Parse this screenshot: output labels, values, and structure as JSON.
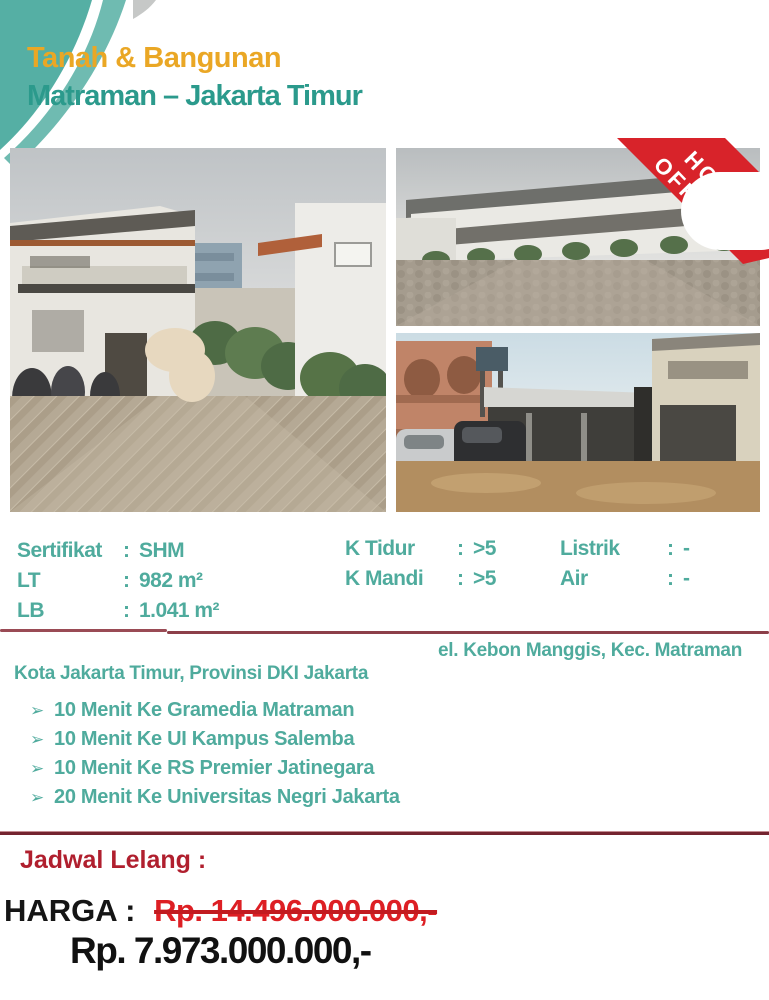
{
  "header": {
    "title": "Tanah & Bangunan",
    "subtitle": "Matraman – Jakarta Timur"
  },
  "badge": {
    "line1": "HOT",
    "line2": "OFFER"
  },
  "details": {
    "colon": ":",
    "left": [
      {
        "label": "Sertifikat",
        "value": "SHM"
      },
      {
        "label": "LT",
        "value": "982 m²"
      },
      {
        "label": "LB",
        "value": "1.041 m²"
      }
    ],
    "middle": [
      {
        "label": "K Tidur",
        "value": ">5"
      },
      {
        "label": "K Mandi",
        "value": ">5"
      }
    ],
    "right": [
      {
        "label": "Listrik",
        "value": "-"
      },
      {
        "label": "Air",
        "value": "-"
      }
    ]
  },
  "location": {
    "line1": "el. Kebon Manggis, Kec. Matraman",
    "line2": "Kota Jakarta Timur, Provinsi DKI Jakarta"
  },
  "landmarks": {
    "bullet": "➢",
    "items": [
      "10 Menit Ke Gramedia Matraman",
      "10 Menit Ke UI Kampus Salemba",
      "10 Menit Ke RS Premier Jatinegara",
      "20 Menit Ke Universitas Negri Jakarta"
    ]
  },
  "auction": {
    "schedule_label": "Jadwal Lelang :"
  },
  "pricing": {
    "label": "HARGA :",
    "old_price": "Rp. 14.496.000.000,-",
    "new_price": "Rp. 7.973.000.000,-"
  },
  "colors": {
    "title_gold": "#EAA725",
    "teal_dark": "#2B9A8C",
    "teal_text": "#4FAB9D",
    "ribbon_red": "#D8232A",
    "old_price_red": "#DD1F24",
    "schedule_red": "#B01F2E",
    "separator_rose": "#9A4B55",
    "separator_maroon": "#74242F",
    "price_black": "#151515"
  }
}
